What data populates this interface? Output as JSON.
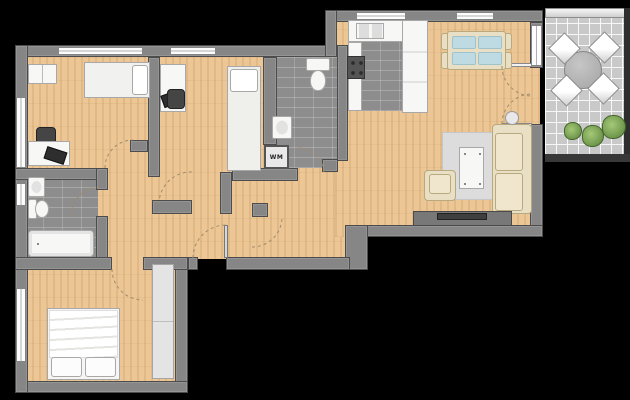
{
  "labels": {
    "washing_machine": "WM"
  },
  "colors": {
    "background": "#000000",
    "wall": "#868686",
    "wall_edge": "#4c4c4c",
    "wood": "#ecc795",
    "tile": "#8d8d8d",
    "balcony_tile": "#c9c9c9",
    "cream": "#e9dfc4",
    "cream_edge": "#b9a97f",
    "glass": "#bedbe3",
    "white_fixture": "#f7f7f6",
    "dark_furniture": "#454545",
    "plant": "#57823a",
    "rug": "#dcdcdc",
    "tv_board": "#787878",
    "arc": "#a08a6a"
  }
}
